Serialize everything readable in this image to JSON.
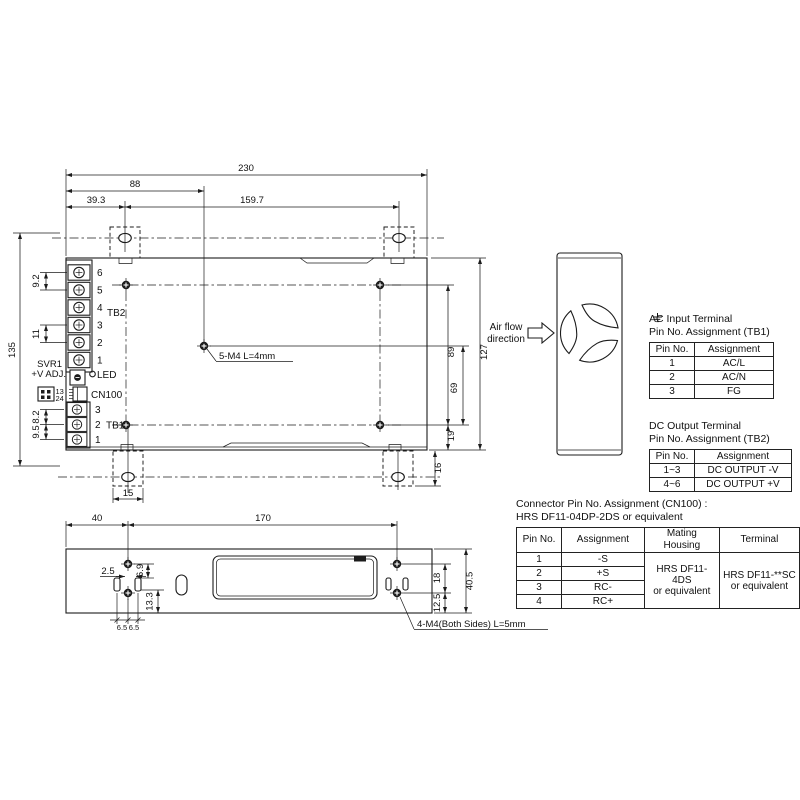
{
  "drawing": {
    "top_view": {
      "dim_230": "230",
      "dim_88": "88",
      "dim_39_3": "39.3",
      "dim_159_7": "159.7",
      "dim_135": "135",
      "dim_9_2": "9.2",
      "dim_11": "11",
      "dim_8_2": "8.2",
      "dim_9_5": "9.5",
      "dim_89": "89",
      "dim_69": "69",
      "dim_127": "127",
      "dim_19": "19",
      "dim_16": "16",
      "dim_15": "15",
      "screw_callout": "5-M4 L=4mm",
      "svr1_label_line1": "SVR1",
      "svr1_label_line2": "+V ADJ.",
      "led_label": "LED",
      "cn100_label": "CN100",
      "cn100_pins_top": "13",
      "cn100_pins_bottom": "24",
      "tb2_label": "TB2",
      "tb1_label": "TB1",
      "tb2_pins": [
        "6",
        "5",
        "4",
        "3",
        "2",
        "1"
      ],
      "tb1_pins": [
        "3",
        "2",
        "1"
      ]
    },
    "side_view": {
      "airflow_line1": "Air flow",
      "airflow_line2": "direction"
    },
    "bottom_view": {
      "dim_40": "40",
      "dim_170": "170",
      "dim_2_5": "2.5",
      "dim_6_9": "6.9",
      "dim_13_3": "13.3",
      "dim_6_5_left": "6.5",
      "dim_6_5_right": "6.5",
      "dim_18": "18",
      "dim_12_5": "12.5",
      "dim_40_5": "40.5",
      "screw_callout": "4-M4(Both Sides) L=5mm"
    }
  },
  "tables": {
    "ac_input": {
      "title_line1": "AC Input Terminal",
      "title_line2": "Pin No. Assignment (TB1)",
      "headers": [
        "Pin No.",
        "Assignment"
      ],
      "rows": [
        [
          "1",
          "AC/L"
        ],
        [
          "2",
          "AC/N"
        ],
        [
          "3",
          "FG"
        ]
      ]
    },
    "dc_output": {
      "title_line1": "DC Output Terminal",
      "title_line2": "Pin No. Assignment (TB2)",
      "headers": [
        "Pin No.",
        "Assignment"
      ],
      "rows": [
        [
          "1~3",
          "DC OUTPUT -V"
        ],
        [
          "4~6",
          "DC OUTPUT +V"
        ]
      ]
    },
    "cn100": {
      "title_line1": "Connector Pin No. Assignment (CN100) :",
      "title_line2": "HRS DF11-04DP-2DS or equivalent",
      "headers": [
        "Pin No.",
        "Assignment",
        "Mating Housing",
        "Terminal"
      ],
      "pin_rows": [
        [
          "1",
          "-S"
        ],
        [
          "2",
          "+S"
        ],
        [
          "3",
          "RC-"
        ],
        [
          "4",
          "RC+"
        ]
      ],
      "mating_housing_line1": "HRS DF11-4DS",
      "mating_housing_line2": "or equivalent",
      "terminal_line1": "HRS DF11-**SC",
      "terminal_line2": "or equivalent"
    }
  }
}
